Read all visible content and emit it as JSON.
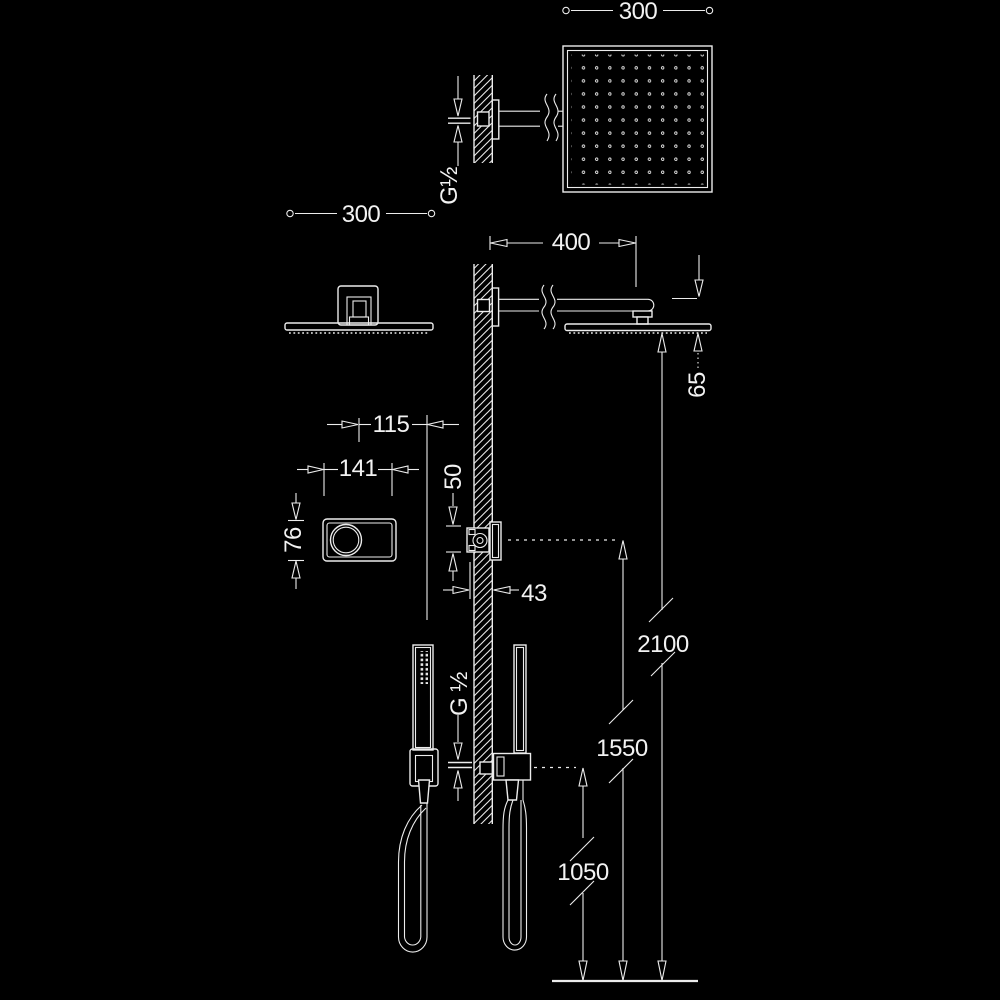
{
  "colors": {
    "background": "#000000",
    "line": "#ececec",
    "text": "#f2f2f2"
  },
  "drawing": {
    "type": "technical-installation-diagram",
    "subject": "concealed shower set: overhead square shower head on wall arm, concealed mixer valve, hand shower with hose",
    "views": [
      "plan-view-head",
      "front-view-head",
      "front-view-valve",
      "front-view-handshower",
      "side-elevation-on-wall"
    ]
  },
  "dimensions": {
    "head_width_plan": "300",
    "head_width_front": "300",
    "arm_length": "400",
    "head_drop": "65",
    "valve_offset": "115",
    "valve_plate_width": "141",
    "valve_plate_height": "76",
    "valve_body_height": "50",
    "valve_depth": "43",
    "height_head": "2100",
    "height_valve": "1550",
    "height_handshower": "1050",
    "thread_top": "G½",
    "thread_bottom": "G ½"
  }
}
